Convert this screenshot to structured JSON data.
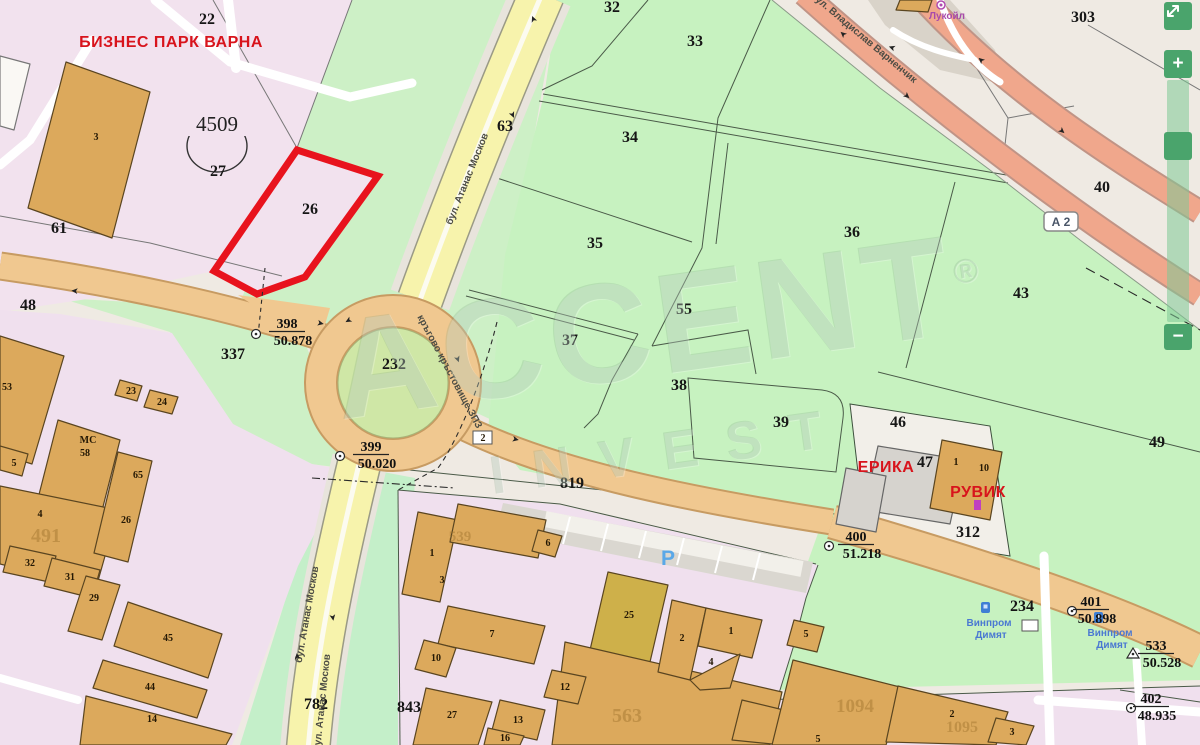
{
  "colors": {
    "highlight_red": "#e8131d",
    "label_red": "#d8141c",
    "road_tan": "#f0c890",
    "road_yellow": "#f7f3ac",
    "highway_salmon": "#f0a78c",
    "zone_pink": "#f2e2ee",
    "zone_green": "#c7f2c0",
    "zone_beige": "#efeae3",
    "building_tan": "#dca95c",
    "control_green": "#4aa46c",
    "poi_purple": "#a84aaa",
    "poi_blue": "#4a78d2",
    "parking_blue": "#5aa8e8"
  },
  "watermark": {
    "line1": "ACCENT",
    "symbol": "®",
    "line2": "INVEST"
  },
  "controls": {
    "zoom_in": "+",
    "zoom_out": "−"
  },
  "map": {
    "district": {
      "t": "4509",
      "x": 217,
      "y": 131
    },
    "road_badge": {
      "t": "А 2",
      "x": 1061,
      "y": 226
    },
    "parking_label": {
      "t": "P",
      "x": 668,
      "y": 565
    },
    "region_labels": [
      {
        "t": "22",
        "x": 207,
        "y": 24,
        "s": 15
      },
      {
        "t": "27",
        "x": 218,
        "y": 176,
        "s": 15
      },
      {
        "t": "26",
        "x": 310,
        "y": 214,
        "s": 15
      },
      {
        "t": "61",
        "x": 59,
        "y": 233
      },
      {
        "t": "48",
        "x": 28,
        "y": 310
      },
      {
        "t": "337",
        "x": 233,
        "y": 359
      },
      {
        "t": "232",
        "x": 394,
        "y": 369,
        "s": 14
      },
      {
        "t": "63",
        "x": 505,
        "y": 131
      },
      {
        "t": "32",
        "x": 612,
        "y": 12
      },
      {
        "t": "33",
        "x": 695,
        "y": 46
      },
      {
        "t": "34",
        "x": 630,
        "y": 142
      },
      {
        "t": "35",
        "x": 595,
        "y": 248
      },
      {
        "t": "36",
        "x": 852,
        "y": 237
      },
      {
        "t": "37",
        "x": 570,
        "y": 345
      },
      {
        "t": "38",
        "x": 679,
        "y": 390
      },
      {
        "t": "39",
        "x": 781,
        "y": 427
      },
      {
        "t": "40",
        "x": 1102,
        "y": 192
      },
      {
        "t": "43",
        "x": 1021,
        "y": 298
      },
      {
        "t": "46",
        "x": 898,
        "y": 427
      },
      {
        "t": "47",
        "x": 925,
        "y": 467
      },
      {
        "t": "49",
        "x": 1157,
        "y": 447
      },
      {
        "t": "55",
        "x": 684,
        "y": 314
      },
      {
        "t": "303",
        "x": 1083,
        "y": 22,
        "s": 17
      },
      {
        "t": "819",
        "x": 572,
        "y": 488,
        "s": 14
      },
      {
        "t": "782",
        "x": 316,
        "y": 709
      },
      {
        "t": "843",
        "x": 409,
        "y": 712
      },
      {
        "t": "234",
        "x": 1022,
        "y": 611,
        "s": 17
      },
      {
        "t": "312",
        "x": 968,
        "y": 537,
        "s": 15
      }
    ],
    "building_labels": [
      {
        "t": "3",
        "x": 96,
        "y": 140
      },
      {
        "t": "53",
        "x": 7,
        "y": 390
      },
      {
        "t": "МС",
        "x": 88,
        "y": 443,
        "s": 13
      },
      {
        "t": "58",
        "x": 85,
        "y": 456
      },
      {
        "t": "5",
        "x": 14,
        "y": 466
      },
      {
        "t": "4",
        "x": 40,
        "y": 517
      },
      {
        "t": "23",
        "x": 131,
        "y": 394
      },
      {
        "t": "24",
        "x": 162,
        "y": 405
      },
      {
        "t": "65",
        "x": 138,
        "y": 478
      },
      {
        "t": "26",
        "x": 126,
        "y": 523
      },
      {
        "t": "32",
        "x": 30,
        "y": 566
      },
      {
        "t": "31",
        "x": 70,
        "y": 580
      },
      {
        "t": "29",
        "x": 94,
        "y": 601
      },
      {
        "t": "45",
        "x": 168,
        "y": 641
      },
      {
        "t": "44",
        "x": 150,
        "y": 690
      },
      {
        "t": "14",
        "x": 152,
        "y": 722
      },
      {
        "t": "1",
        "x": 432,
        "y": 556
      },
      {
        "t": "3",
        "x": 442,
        "y": 583
      },
      {
        "t": "6",
        "x": 548,
        "y": 546
      },
      {
        "t": "7",
        "x": 492,
        "y": 637
      },
      {
        "t": "10",
        "x": 436,
        "y": 661
      },
      {
        "t": "25",
        "x": 629,
        "y": 618
      },
      {
        "t": "2",
        "x": 682,
        "y": 641
      },
      {
        "t": "1",
        "x": 731,
        "y": 634
      },
      {
        "t": "4",
        "x": 711,
        "y": 665
      },
      {
        "t": "12",
        "x": 565,
        "y": 690
      },
      {
        "t": "13",
        "x": 518,
        "y": 723
      },
      {
        "t": "16",
        "x": 505,
        "y": 741
      },
      {
        "t": "27",
        "x": 452,
        "y": 718
      },
      {
        "t": "5",
        "x": 806,
        "y": 637
      },
      {
        "t": "1",
        "x": 956,
        "y": 465
      },
      {
        "t": "10",
        "x": 984,
        "y": 471
      },
      {
        "t": "2",
        "x": 952,
        "y": 717
      },
      {
        "t": "3",
        "x": 1012,
        "y": 735
      },
      {
        "t": "5",
        "x": 818,
        "y": 742
      }
    ],
    "faded_labels": [
      {
        "t": "491",
        "x": 46,
        "y": 542,
        "s": 20
      },
      {
        "t": "539",
        "x": 460,
        "y": 541,
        "s": 15
      },
      {
        "t": "563",
        "x": 627,
        "y": 722,
        "s": 20
      },
      {
        "t": "1094",
        "x": 855,
        "y": 712,
        "s": 19
      },
      {
        "t": "1095",
        "x": 962,
        "y": 732,
        "s": 16
      }
    ],
    "red_labels": [
      {
        "t": "БИЗНЕС ПАРК ВАРНА",
        "x": 171,
        "y": 47,
        "s": 17
      },
      {
        "t": "ЕРИКА",
        "x": 886,
        "y": 472
      },
      {
        "t": "РУВИК",
        "x": 978,
        "y": 497
      }
    ],
    "street_labels": [
      {
        "t": "бул. Атанас Москов",
        "x": 470,
        "y": 180,
        "r": -68
      },
      {
        "t": "бул. Атанас Москов",
        "x": 310,
        "y": 615,
        "r": -80
      },
      {
        "t": "бул. Атанас Москов",
        "x": 325,
        "y": 703,
        "r": -84
      },
      {
        "t": "бул. Владислав Варненчик",
        "x": 862,
        "y": 40,
        "r": 40,
        "s": 11
      },
      {
        "t": "кръгово кръстовище ЗПЗ",
        "x": 447,
        "y": 373,
        "r": 62
      }
    ],
    "poi_labels": [
      {
        "t": "Лукойл",
        "x": 947,
        "y": 19,
        "c": "#a84aaa"
      },
      {
        "t": "Винпром",
        "x": 989,
        "y": 626,
        "c": "#4a78d2"
      },
      {
        "t": "Димят",
        "x": 991,
        "y": 638,
        "c": "#4a78d2"
      },
      {
        "t": "Винпром",
        "x": 1110,
        "y": 636,
        "c": "#4a78d2"
      },
      {
        "t": "Димят",
        "x": 1112,
        "y": 648,
        "c": "#4a78d2"
      }
    ],
    "box_labels": [
      {
        "t": "2",
        "x": 483,
        "y": 441
      }
    ],
    "benchmarks": [
      {
        "n": "398",
        "e": "50.878",
        "mx": 256,
        "my": 334,
        "tx": 287,
        "ty": 328,
        "m": "c"
      },
      {
        "n": "399",
        "e": "50.020",
        "mx": 340,
        "my": 456,
        "tx": 371,
        "ty": 451,
        "m": "c"
      },
      {
        "n": "400",
        "e": "51.218",
        "mx": 829,
        "my": 546,
        "tx": 856,
        "ty": 541,
        "m": "c"
      },
      {
        "n": "401",
        "e": "50.898",
        "mx": 1072,
        "my": 611,
        "tx": 1091,
        "ty": 606,
        "m": "c"
      },
      {
        "n": "533",
        "e": "50.528",
        "mx": 1133,
        "my": 654,
        "tx": 1156,
        "ty": 650,
        "m": "t"
      },
      {
        "n": "402",
        "e": "48.935",
        "mx": 1131,
        "my": 708,
        "tx": 1151,
        "ty": 703,
        "m": "c"
      }
    ],
    "arrows": [
      [
        75,
        288,
        185
      ],
      [
        320,
        326,
        12
      ],
      [
        347,
        318,
        150
      ],
      [
        455,
        360,
        70
      ],
      [
        515,
        442,
        12
      ],
      [
        536,
        18,
        248
      ],
      [
        510,
        116,
        66
      ],
      [
        330,
        618,
        80
      ],
      [
        300,
        656,
        262
      ],
      [
        845,
        32,
        222
      ],
      [
        905,
        98,
        42
      ],
      [
        983,
        58,
        222
      ],
      [
        1060,
        133,
        42
      ],
      [
        893,
        45,
        200
      ]
    ]
  }
}
